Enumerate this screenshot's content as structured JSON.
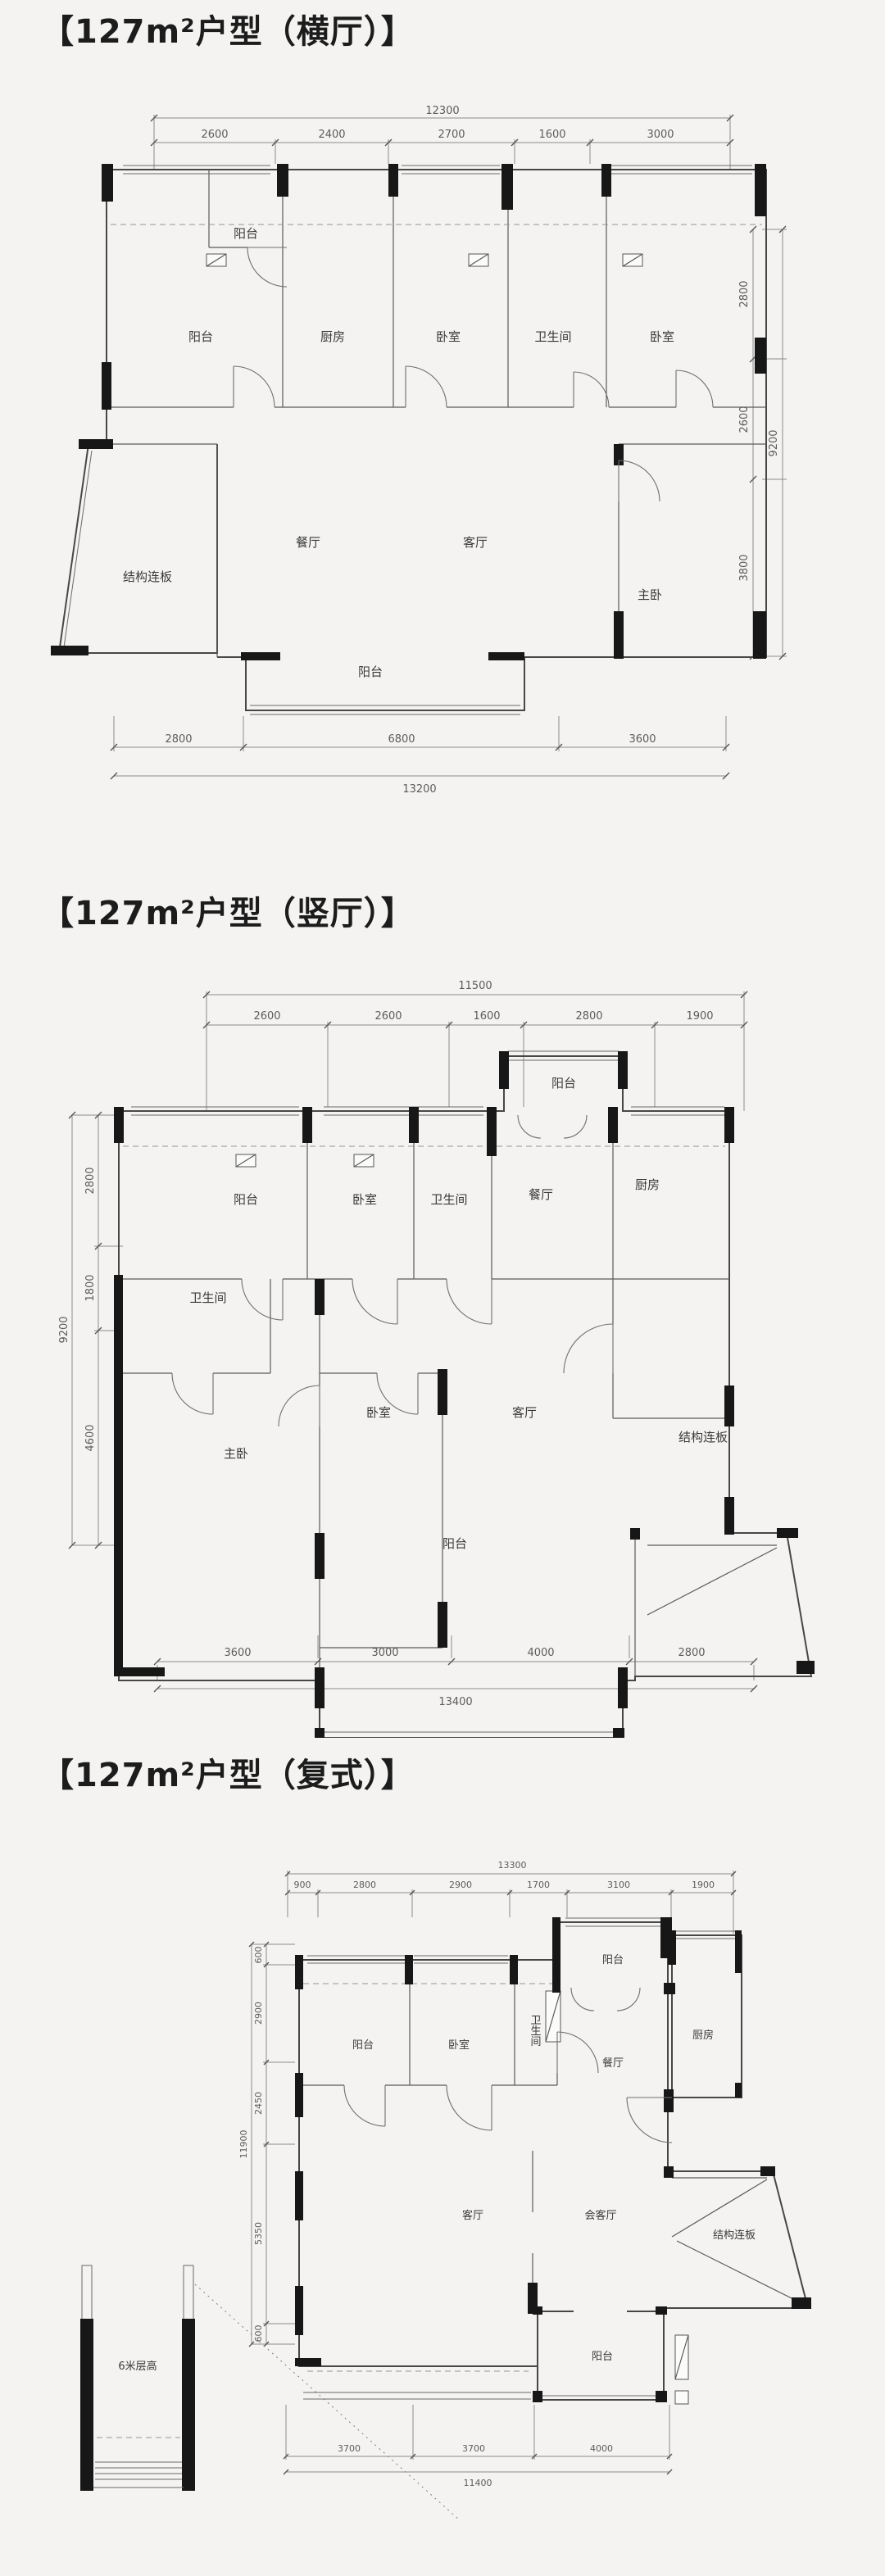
{
  "sections": [
    {
      "title": "【127m²户型（横厅）】",
      "rooms": {
        "balcony_top": "阳台",
        "balcony_left": "阳台",
        "kitchen": "厨房",
        "bedroom1": "卧室",
        "bathroom": "卫生间",
        "bedroom2": "卧室",
        "dining": "餐厅",
        "living": "客厅",
        "master": "主卧",
        "slab": "结构连板",
        "balcony_bottom": "阳台"
      },
      "dims": {
        "top_total": "12300",
        "top_segments": [
          "2600",
          "2400",
          "2700",
          "1600",
          "3000"
        ],
        "right_total": "9200",
        "right_segments": [
          "2800",
          "2600",
          "3800"
        ],
        "bottom_segments": [
          "2800",
          "6800",
          "3600"
        ],
        "bottom_total": "13200"
      }
    },
    {
      "title": "【127m²户型（竖厅）】",
      "rooms": {
        "balcony_top": "阳台",
        "balcony_left": "阳台",
        "bedroom1": "卧室",
        "bathroom1": "卫生间",
        "dining": "餐厅",
        "kitchen": "厨房",
        "bathroom2": "卫生间",
        "master": "主卧",
        "bedroom2": "卧室",
        "living": "客厅",
        "slab": "结构连板",
        "balcony_bottom": "阳台"
      },
      "dims": {
        "top_total": "11500",
        "top_segments": [
          "2600",
          "2600",
          "1600",
          "2800",
          "1900"
        ],
        "left_total": "9200",
        "left_segments": [
          "2800",
          "1800",
          "4600"
        ],
        "bottom_segments": [
          "3600",
          "3000",
          "4000",
          "2800"
        ],
        "bottom_total": "13400"
      }
    },
    {
      "title": "【127m²户型（复式）】",
      "rooms": {
        "balcony_top": "阳台",
        "balcony_left": "阳台",
        "bedroom": "卧室",
        "bathroom": "卫生间",
        "dining": "餐厅",
        "kitchen": "厨房",
        "living": "客厅",
        "reception": "会客厅",
        "slab": "结构连板",
        "balcony_bottom": "阳台",
        "loft": "6米层高"
      },
      "dims": {
        "top_total": "13300",
        "top_segments": [
          "900",
          "2800",
          "2900",
          "1700",
          "3100",
          "1900"
        ],
        "left_total": "11900",
        "left_segments": [
          "600",
          "2900",
          "2450",
          "5350",
          "600"
        ],
        "bottom_segments": [
          "3700",
          "3700",
          "4000"
        ],
        "bottom_total": "11400"
      }
    }
  ]
}
